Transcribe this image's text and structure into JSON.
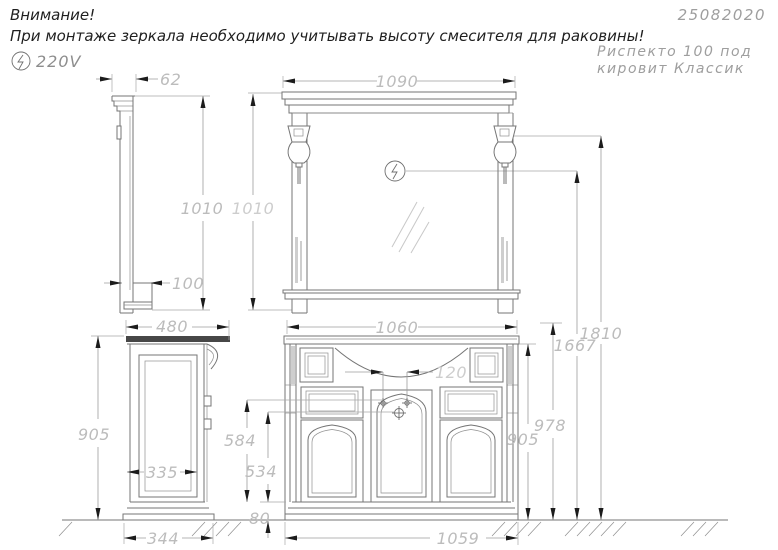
{
  "header": {
    "attention_line1": "Внимание!",
    "attention_line2": "При монтаже зеркала необходимо учитывать высоту смесителя для раковины!",
    "voltage": "220V",
    "doc_number": "25082020",
    "product_line1": "Риспекто 100 под",
    "product_line2": "кировит Классик"
  },
  "dimensions_mm": {
    "mirror_depth": "62",
    "mirror_height_side": "1010",
    "mirror_height_front": "1010",
    "mirror_shelf_depth": "100",
    "mirror_width": "1090",
    "washbasin_top_width": "1060",
    "cabinet_depth": "480",
    "cabinet_height_side": "905",
    "cabinet_panel_depth": "335",
    "cabinet_base_depth": "344",
    "faucet_hole_spacing": "120",
    "faucet_hole_height": "584",
    "drain_height": "534",
    "plinth_height": "80",
    "cabinet_base_width": "1059",
    "worktop_height": "905",
    "backsplash_height": "978",
    "socket_height": "1667",
    "lamp_height": "1810"
  },
  "colors": {
    "furniture_line": "#757575",
    "dimension_line": "#9c9c9c",
    "dimension_text": "#bcbcbc",
    "text_dark": "#1f1f1f",
    "text_gray": "#9e9e9e",
    "arrow": "#1c1c1c"
  }
}
